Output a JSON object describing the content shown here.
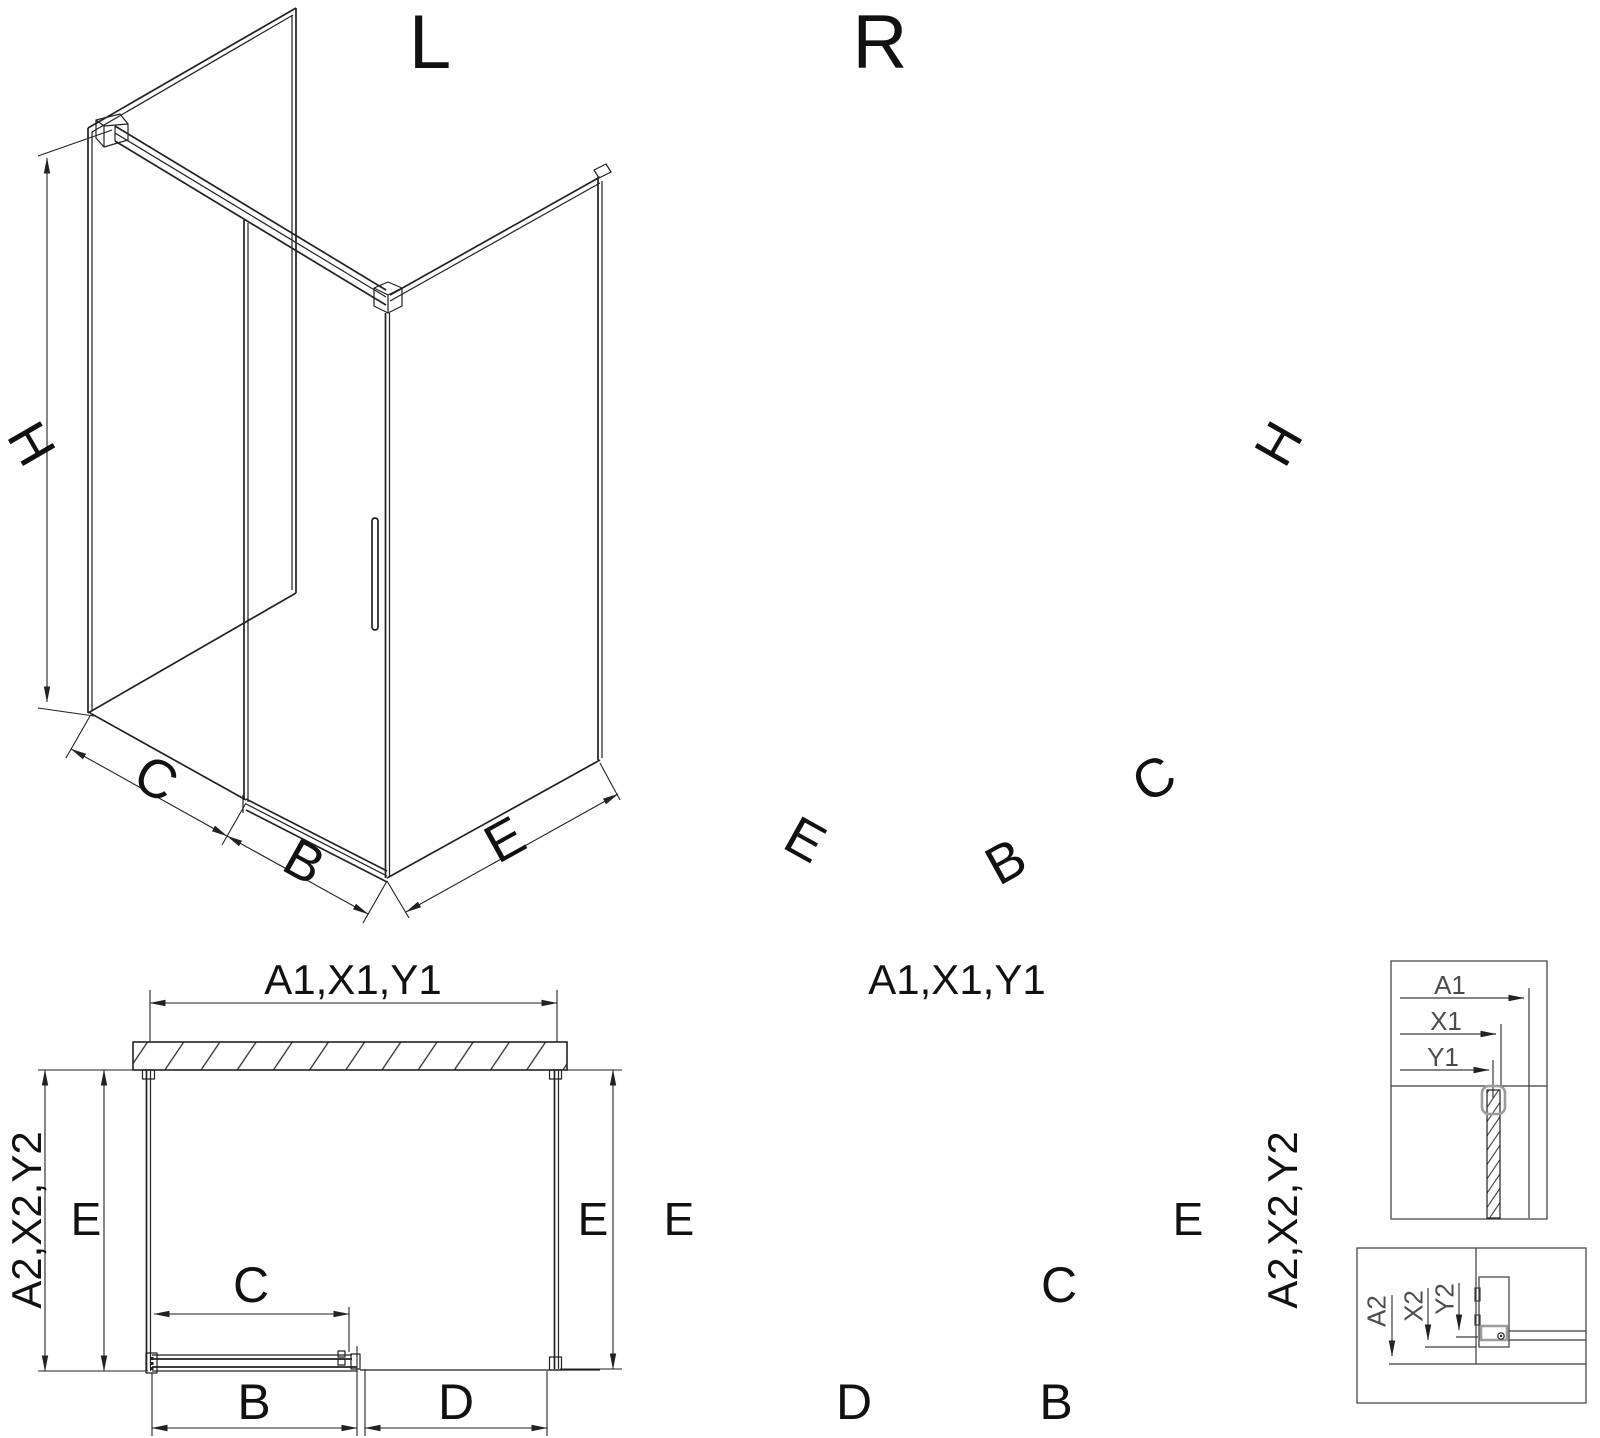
{
  "diagram": {
    "views": {
      "iso_left": {
        "title": "L",
        "h": "H",
        "c": "C",
        "b": "B",
        "e": "E"
      },
      "iso_right": {
        "title": "R",
        "h": "H",
        "c": "C",
        "b": "B",
        "e": "E"
      },
      "plan_left": {
        "width_top": "A1,X1,Y1",
        "depth_side": "A2,X2,Y2",
        "e_left": "E",
        "e_right": "E",
        "c": "C",
        "b": "B",
        "d": "D"
      },
      "plan_right": {
        "width_top": "A1,X1,Y1",
        "depth_side": "A2,X2,Y2",
        "e_left": "E",
        "e_right": "E",
        "c": "C",
        "b": "B",
        "d": "D"
      },
      "detail_wall": {
        "a1": "A1",
        "x1": "X1",
        "y1": "Y1"
      },
      "detail_floor": {
        "a2": "A2",
        "x2": "X2",
        "y2": "Y2"
      }
    },
    "colors": {
      "line": "#222222",
      "detail_text": "#4d4d4d",
      "profile_gray": "#9c9c9c",
      "background": "#ffffff"
    }
  }
}
